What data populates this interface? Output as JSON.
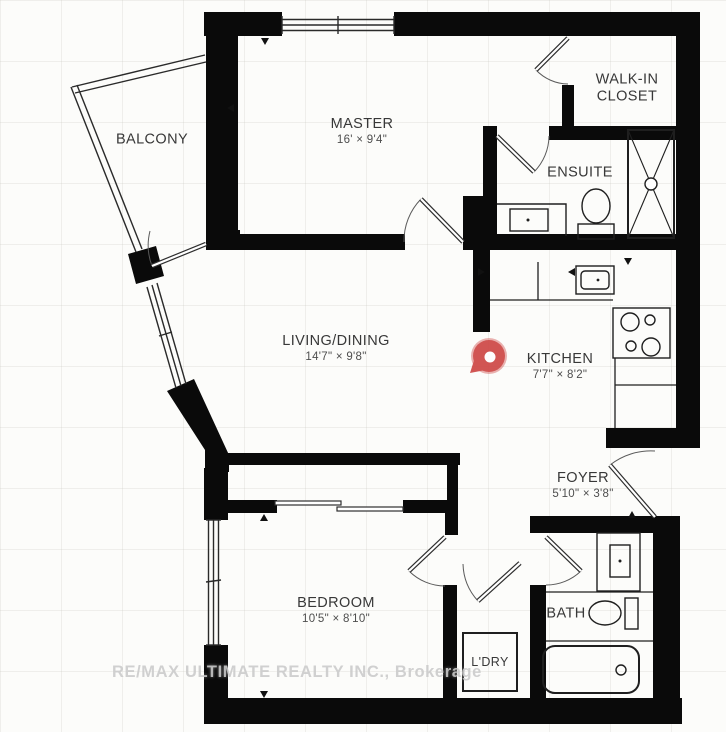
{
  "watermark": "RE/MAX ULTIMATE REALTY INC., Brokerage",
  "rooms": {
    "balcony": {
      "label": "BALCONY"
    },
    "master": {
      "label": "MASTER",
      "dims": "16' × 9'4\""
    },
    "walkin_closet": {
      "label": "WALK-IN CLOSET"
    },
    "ensuite": {
      "label": "ENSUITE"
    },
    "living_dining": {
      "label": "LIVING/DINING",
      "dims": "14'7\" × 9'8\""
    },
    "kitchen": {
      "label": "KITCHEN",
      "dims": "7'7\" × 8'2\""
    },
    "foyer": {
      "label": "FOYER",
      "dims": "5'10\" × 3'8\""
    },
    "bedroom": {
      "label": "BEDROOM",
      "dims": "10'5\" × 8'10\""
    },
    "bath": {
      "label": "BATH"
    },
    "laundry": {
      "label": "L'DRY"
    }
  },
  "icons": {
    "location_pin": "red map pin marker"
  },
  "colors": {
    "walls": "#0a0a0a",
    "pin": "#ce4947",
    "label_text": "#383838",
    "watermark_text": "#cacaca"
  }
}
